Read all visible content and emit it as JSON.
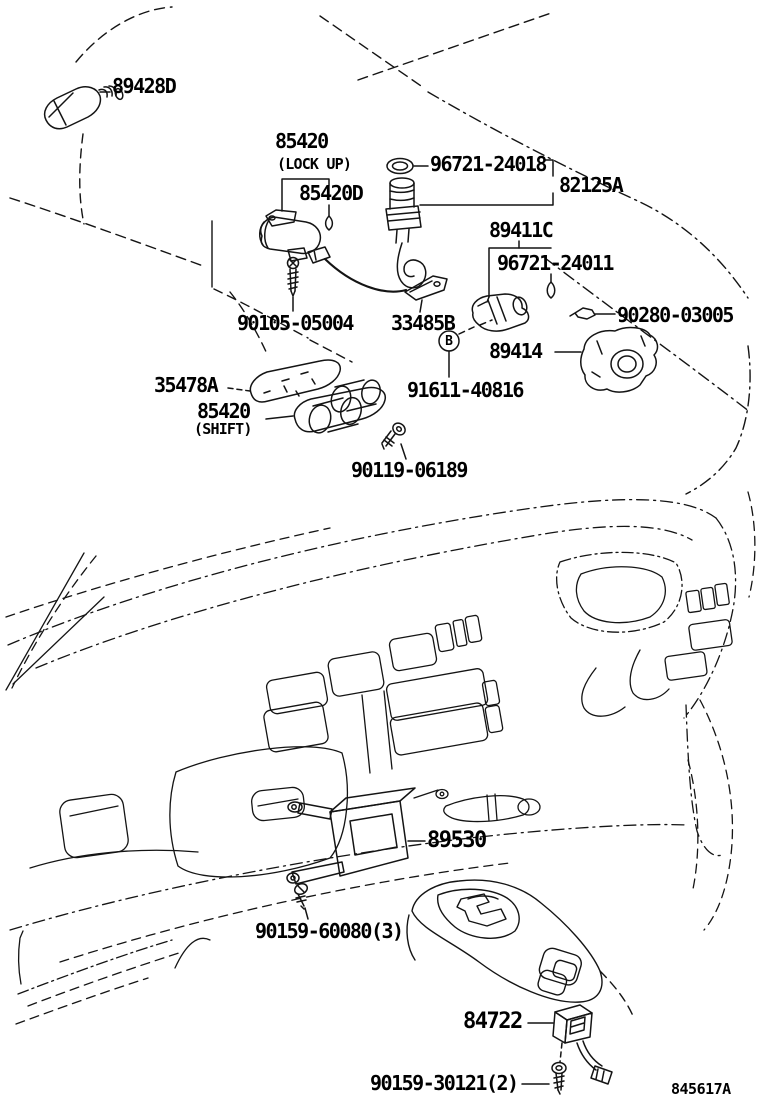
{
  "diagram": {
    "background_color": "#ffffff",
    "line_color": "#141414",
    "code": "845617A",
    "callout_b": "B",
    "parts": [
      {
        "label": "89428D"
      },
      {
        "label": "85420"
      },
      {
        "label": "(LOCK UP)"
      },
      {
        "label": "85420D"
      },
      {
        "label": "96721-24018"
      },
      {
        "label": "82125A"
      },
      {
        "label": "89411C"
      },
      {
        "label": "96721-24011"
      },
      {
        "label": "90105-05004"
      },
      {
        "label": "33485B"
      },
      {
        "label": "90280-03005"
      },
      {
        "label": "89414"
      },
      {
        "label": "91611-40816"
      },
      {
        "label": "35478A"
      },
      {
        "label": "85420"
      },
      {
        "label": "(SHIFT)"
      },
      {
        "label": "90119-06189"
      },
      {
        "label": "89530"
      },
      {
        "label": "90159-60080(3)"
      },
      {
        "label": "84722"
      },
      {
        "label": "90159-30121(2)"
      }
    ]
  }
}
